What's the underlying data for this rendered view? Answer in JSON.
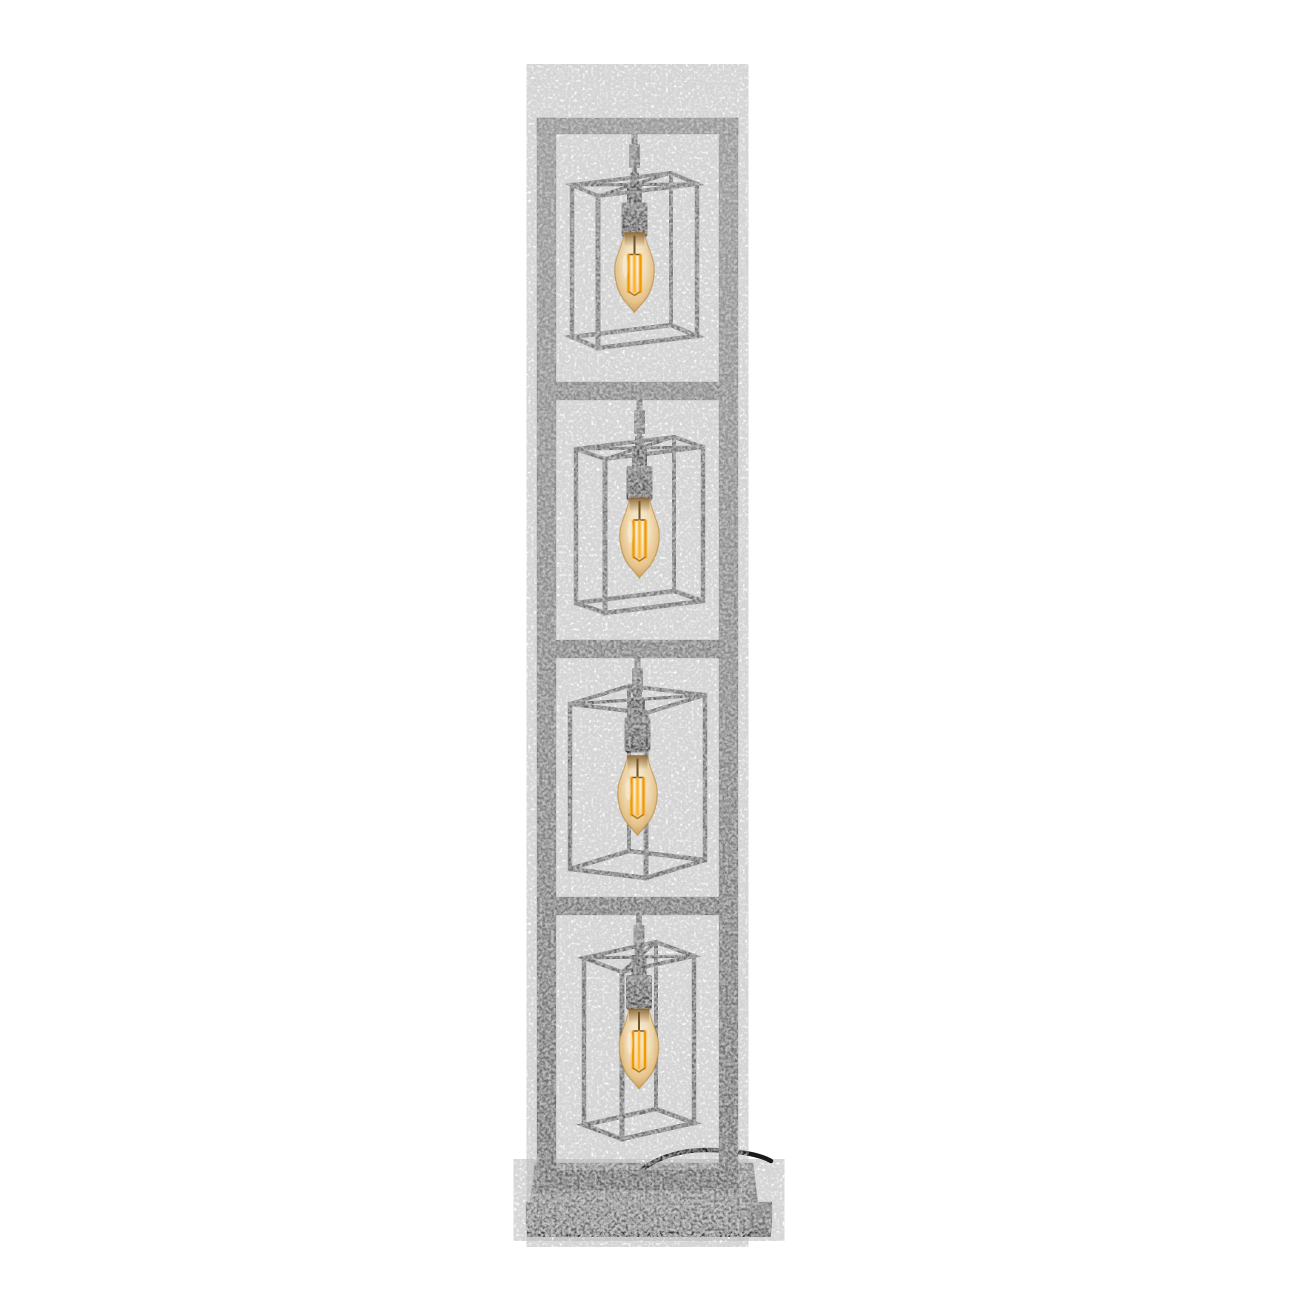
{
  "scene": {
    "kind": "product-photo",
    "subject": "Industrial floor lamp: tall ladder frame of aged silver metal with four stacked open cube cages, each holding a lit amber Edison filament bulb, on a rectangular concrete-grey base with a black power cable",
    "background": "#ffffff",
    "canvas": {
      "w": 1300,
      "h": 1300
    },
    "bulb_count": 4
  },
  "palette": {
    "frame_top": "#a0a0a0",
    "frame_mid": "#8d8d8d",
    "frame_bottom": "#6c6c6c",
    "edge_line": "#4f4f4f",
    "sleeve_light": "#a2a2a2",
    "sleeve_dark": "#787878",
    "socket_top": "#7d7d7d",
    "socket_bottom": "#454545",
    "socket_strap": "#565656",
    "socket_rim": "#2c2c2c",
    "base_top_light": "#929292",
    "base_top_dark": "#7d7d7d",
    "base_front_light": "#7d7d7d",
    "base_front_dark": "#6d6d6d",
    "base_lower_light": "#767676",
    "base_lower_dark": "#5e5e5e",
    "base_bottom_edge": "#383838",
    "glass_core": "#faf3e0",
    "glass_mid": "#f4e0bc",
    "glass_amber": "#e6c286",
    "glass_edge": "#c08b3e",
    "glass_outline": "#a97b33",
    "neck_shadow": "#5a370f",
    "filament": "#ef9b08",
    "filament_center": "#ffb52b",
    "filament_glow": "#ffaf2e",
    "stem_wire": "#6f5426",
    "cable": "#1b1b1b"
  },
  "frame": {
    "top_bar": {
      "x": 537,
      "y": 118,
      "w": 201,
      "h": 16,
      "color": "#9b9b9b"
    },
    "left_post": {
      "x": 537,
      "y": 118,
      "w": 19,
      "h": 1075
    },
    "right_post": {
      "x": 719,
      "y": 118,
      "w": 19,
      "h": 1075
    },
    "crossbars": [
      {
        "x": 556,
        "y": 382,
        "w": 163,
        "h": 18,
        "color": "#8f8f8f"
      },
      {
        "x": 556,
        "y": 640,
        "w": 163,
        "h": 18,
        "color": "#868686"
      },
      {
        "x": 556,
        "y": 897,
        "w": 163,
        "h": 18,
        "color": "#7b7b7b"
      }
    ],
    "bottom_rail": {
      "x": 548,
      "y": 1170,
      "w": 190,
      "h": 20,
      "color": "#686868"
    }
  },
  "sections": [
    {
      "rod_from": 134,
      "cage": {
        "o": [
          598,
          196
        ],
        "w": [
          99,
          -12
        ],
        "d": [
          -26,
          -11
        ],
        "h": 152,
        "color": "#7b7b7b"
      },
      "bulb_dy": -2
    },
    {
      "rod_from": 400,
      "cage": {
        "o": [
          605,
          459
        ],
        "w": [
          98,
          -12
        ],
        "d": [
          -29,
          -10
        ],
        "h": 154,
        "color": "#767676"
      },
      "bulb_dy": 0
    },
    {
      "rod_from": 658,
      "cage": {
        "o": [
          646,
          713
        ],
        "w": [
          59,
          -18
        ],
        "d": [
          -76,
          -9
        ],
        "h": 165,
        "color": "#717171"
      },
      "bulb_dy": 6
    },
    {
      "rod_from": 915,
      "cage": {
        "o": [
          622,
          972
        ],
        "w": [
          72,
          -16
        ],
        "d": [
          -38,
          -14
        ],
        "h": 167,
        "color": "#6d6d6d"
      },
      "bulb_dy": 2
    }
  ],
  "bulb": {
    "glass_w": 44,
    "glass_h": 80,
    "strap_h": 20,
    "socket_w": 26,
    "socket_h": 34
  },
  "base": {
    "lower_top": [
      [
        526,
        1202
      ],
      [
        772,
        1202
      ],
      [
        772,
        1222
      ],
      [
        526,
        1222
      ]
    ],
    "lower_front": [
      [
        526,
        1222
      ],
      [
        772,
        1222
      ],
      [
        771,
        1236
      ],
      [
        527,
        1236
      ]
    ],
    "bottom_strip": [
      [
        527,
        1232
      ],
      [
        771,
        1232
      ],
      [
        771,
        1237
      ],
      [
        527,
        1237
      ]
    ],
    "upper_top": [
      [
        535,
        1163
      ],
      [
        753,
        1163
      ],
      [
        758,
        1204
      ],
      [
        530,
        1204
      ]
    ],
    "upper_front": [
      [
        530,
        1204
      ],
      [
        758,
        1204
      ],
      [
        757,
        1222
      ],
      [
        531,
        1222
      ]
    ]
  },
  "cable": {
    "path": "M 643 1169 C 658 1157 682 1150 705 1150 C 730 1150 757 1153 771 1161",
    "color": "#1b1b1b",
    "width": 4.5
  }
}
